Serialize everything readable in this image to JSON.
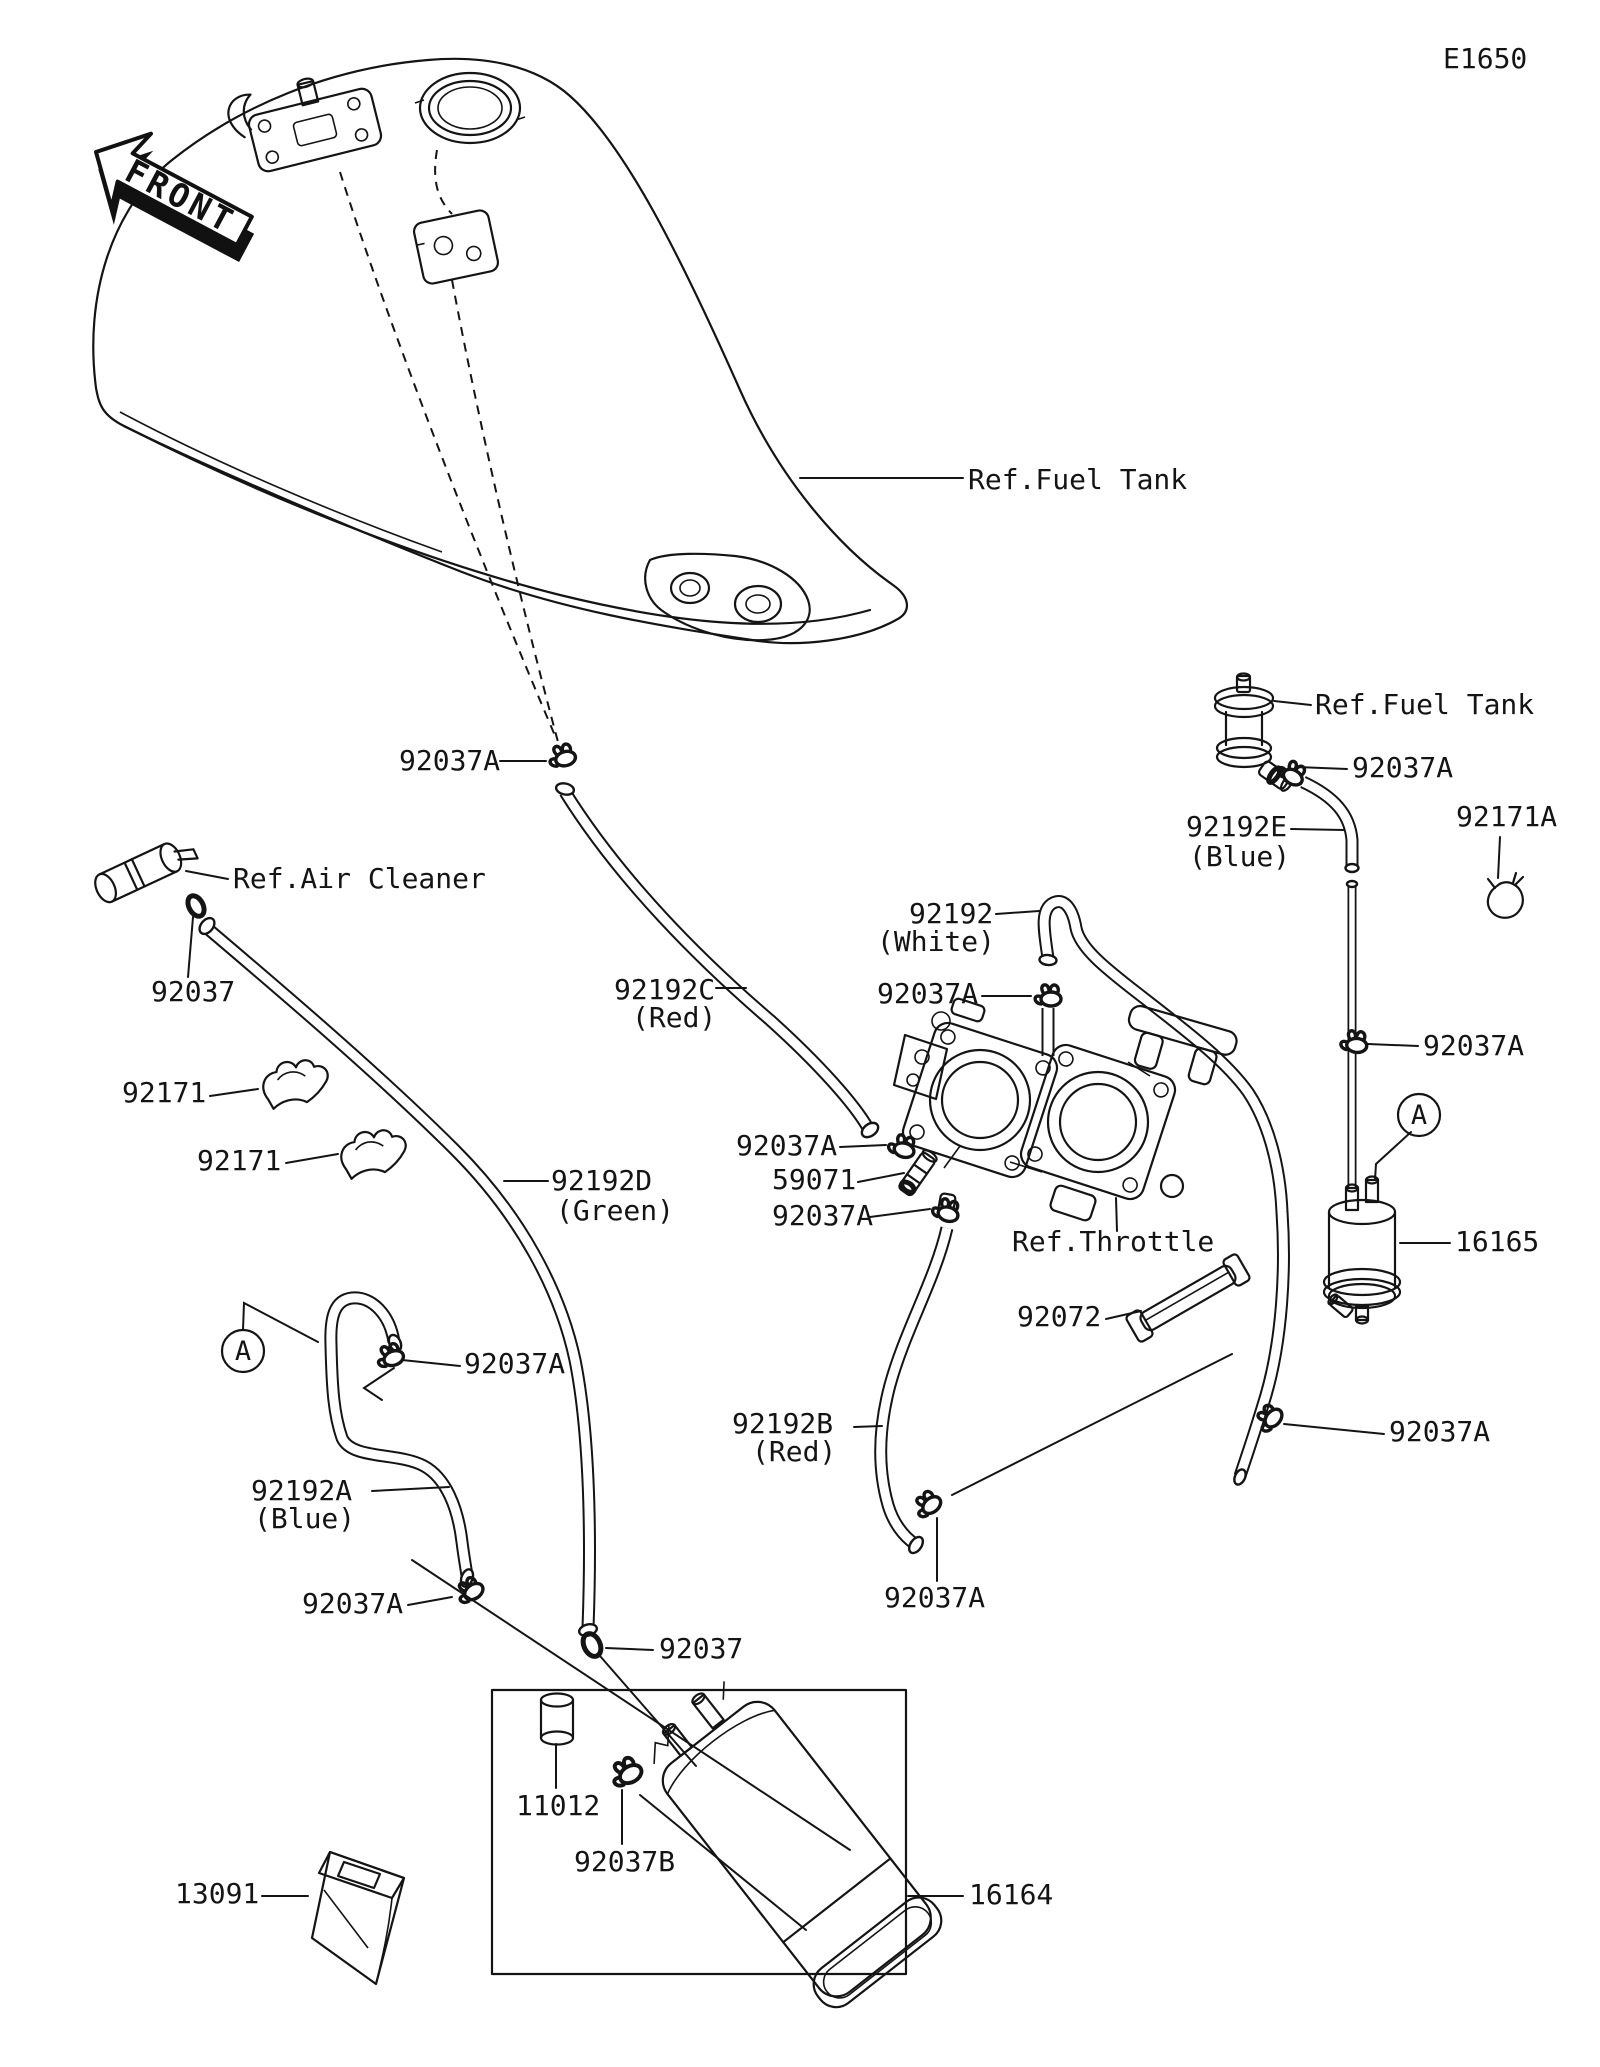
{
  "page": {
    "background": "#ffffff",
    "ink": "#141414"
  },
  "diagram": {
    "code": "E1650",
    "front_badge": "FRONT"
  },
  "markers": {
    "left": "A",
    "right": "A"
  },
  "labels": [
    {
      "id": "ref-fuel-tank-main",
      "text": "Ref.Fuel Tank"
    },
    {
      "id": "clamp-92037a-tank",
      "text": "92037A"
    },
    {
      "id": "ref-air-cleaner",
      "text": "Ref.Air Cleaner"
    },
    {
      "id": "clamp-92037-air",
      "text": "92037"
    },
    {
      "id": "clip-92171-upper",
      "text": "92171"
    },
    {
      "id": "clip-92171-lower",
      "text": "92171"
    },
    {
      "id": "hose-92192c",
      "text": "92192C"
    },
    {
      "id": "hose-92192c-color",
      "text": "(Red)"
    },
    {
      "id": "hose-92192",
      "text": "92192"
    },
    {
      "id": "hose-92192-color",
      "text": "(White)"
    },
    {
      "id": "clamp-92037a-white",
      "text": "92037A"
    },
    {
      "id": "clamp-92037a-joint-top",
      "text": "92037A"
    },
    {
      "id": "joint-59071",
      "text": "59071"
    },
    {
      "id": "clamp-92037a-joint-bottom",
      "text": "92037A"
    },
    {
      "id": "ref-throttle",
      "text": "Ref.Throttle"
    },
    {
      "id": "band-92072",
      "text": "92072"
    },
    {
      "id": "hose-92192d",
      "text": "92192D"
    },
    {
      "id": "hose-92192d-color",
      "text": "(Green)"
    },
    {
      "id": "clamp-92037a-ahose",
      "text": "92037A"
    },
    {
      "id": "hose-92192a",
      "text": "92192A"
    },
    {
      "id": "hose-92192a-color",
      "text": "(Blue)"
    },
    {
      "id": "clamp-92037a-blue-end",
      "text": "92037A"
    },
    {
      "id": "clamp-92037-canister",
      "text": "92037"
    },
    {
      "id": "hose-92192b",
      "text": "92192B"
    },
    {
      "id": "hose-92192b-color",
      "text": "(Red)"
    },
    {
      "id": "clamp-92037a-b-end",
      "text": "92037A"
    },
    {
      "id": "ref-fuel-tank-cock",
      "text": "Ref.Fuel Tank"
    },
    {
      "id": "clamp-92037a-cock",
      "text": "92037A"
    },
    {
      "id": "hose-92192e",
      "text": "92192E"
    },
    {
      "id": "hose-92192e-color",
      "text": "(Blue)"
    },
    {
      "id": "clip-92171a",
      "text": "92171A"
    },
    {
      "id": "clamp-92037a-pipe",
      "text": "92037A"
    },
    {
      "id": "filter-16165",
      "text": "16165"
    },
    {
      "id": "clamp-92037a-white-end",
      "text": "92037A"
    },
    {
      "id": "cap-11012",
      "text": "11012"
    },
    {
      "id": "clamp-92037b",
      "text": "92037B"
    },
    {
      "id": "holder-13091",
      "text": "13091"
    },
    {
      "id": "canister-16164",
      "text": "16164"
    }
  ]
}
